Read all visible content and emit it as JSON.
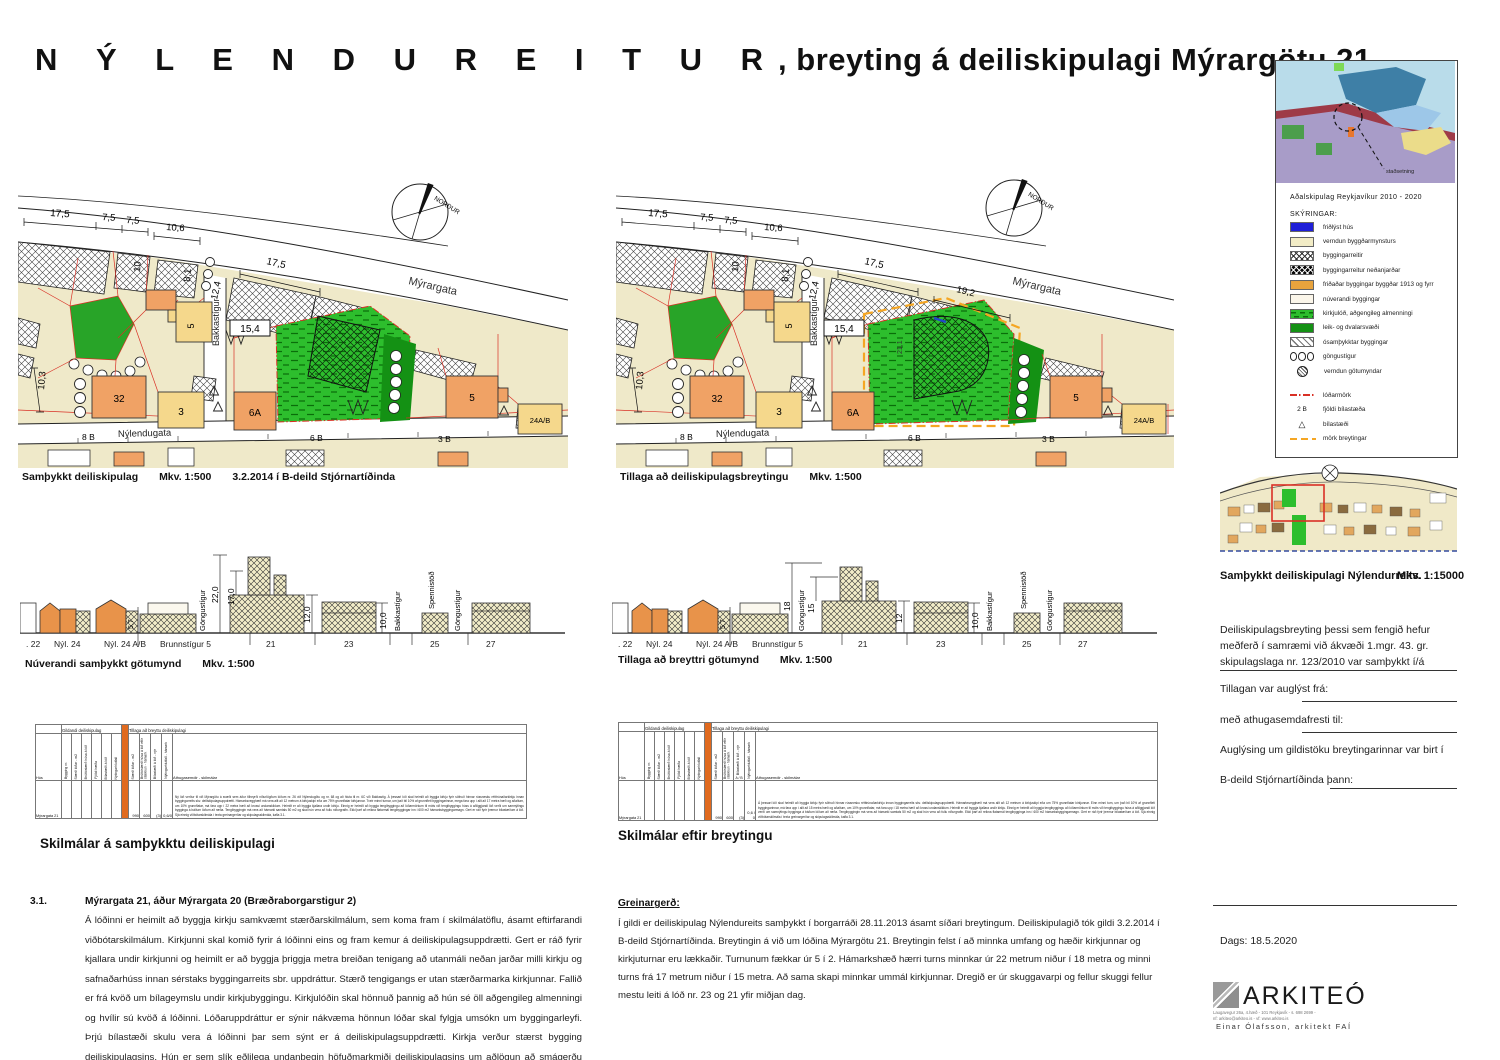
{
  "title": {
    "spaced": "N Ý L E N D U R E I T U R",
    "rest": ", breyting á deiliskipulagi Mýrargötu 21"
  },
  "plan_left": {
    "caption": "Samþykkt deiliskipulag",
    "scale": "Mkv. 1:500",
    "note": "3.2.2014 í B-deild Stjórnartíðinda",
    "north": "NORÐUR",
    "streets": {
      "main": "Mýrargata",
      "cross": "Bakkastígur",
      "bottom": "Nýlendugata"
    },
    "dims": {
      "a": "17,5",
      "b": "7,5",
      "c": "7,5",
      "d": "10,6",
      "e": "10",
      "f": "8,1",
      "g": "12,4",
      "h": "17,5",
      "i": "15,4",
      "j": "10,3"
    },
    "lots": {
      "l1": "8 B",
      "l2": "6 B",
      "l3": "3 B"
    },
    "bld": {
      "b32": "32",
      "b3": "3",
      "b5a": "5",
      "b6a": "6A",
      "b5b": "5",
      "b24": "24A/B"
    }
  },
  "plan_right": {
    "caption": "Tillaga að deiliskipulagsbreytingu",
    "scale": "Mkv. 1:500",
    "north": "NORÐUR",
    "streets": {
      "main": "Mýrargata",
      "cross": "Bakkastígur",
      "bottom": "Nýlendugata"
    },
    "dims": {
      "a": "17,5",
      "b": "7,5",
      "c": "7,5",
      "d": "10,6",
      "e": "10",
      "f": "8,1",
      "g": "12,4",
      "h": "17,5",
      "i": "15,4",
      "j": "10,3",
      "k": "19,2",
      "m": "21,1"
    },
    "lots": {
      "l1": "8 B",
      "l2": "6 B",
      "l3": "3 B"
    },
    "bld": {
      "b32": "32",
      "b3": "3",
      "b5a": "5",
      "b6a": "6A",
      "b5b": "5",
      "b24": "24A/B"
    }
  },
  "elev_left": {
    "caption": "Núverandi samþykkt götumynd",
    "scale": "Mkv. 1:500",
    "heights": {
      "h1": "22,0",
      "h2": "17,0",
      "h3": "12,0",
      "h4": "10,0",
      "h5": "5,7"
    },
    "labels": {
      "v1": "Göngustígur",
      "v2": "Bakkastígur",
      "v3": "Spennistöð",
      "v4": "Göngustígur"
    },
    "lots": {
      "p1": ". 22",
      "p2": "Nýl. 24",
      "p3": "Nýl. 24 A/B",
      "p4": "Brunnstígur 5",
      "p5": "21",
      "p6": "23",
      "p7": "25",
      "p8": "27"
    }
  },
  "elev_right": {
    "caption": "Tillaga að breyttri götumynd",
    "scale": "Mkv. 1:500",
    "heights": {
      "h1": "18",
      "h2": "15",
      "h3": "12",
      "h4": "10,0",
      "h5": "5,7"
    },
    "labels": {
      "v1": "Göngustígur",
      "v2": "Bakkastígur",
      "v3": "Spennistöð",
      "v4": "Göngustígur"
    },
    "lots": {
      "p1": ". 22",
      "p2": "Nýl. 24",
      "p3": "Nýl. 24 A/B",
      "p4": "Brunnstígur 5",
      "p5": "21",
      "p6": "23",
      "p7": "25",
      "p8": "27"
    }
  },
  "table_left": {
    "caption": "Skilmálar á samþykktu deiliskipulagi",
    "group1": "Gildandi deiliskipulag",
    "group2": "Tillaga að breyttu deiliskipulagi",
    "hus": "Hús",
    "note_header": "Athugasemdir - skilmálar",
    "cols": {
      "c1": "Bygging nr.",
      "c2": "Stærð lóðar - m2",
      "c3": "Brúttóstærð húsa á lóð",
      "c4": "Fjöldi hæða",
      "c5": "Bílastæði á lóð",
      "c6": "Nýtingarhlutfall",
      "t1": "Stærð lóðar - m2",
      "t2": "Brúttóstærð húsa á lóð eftir stækkun - hámark",
      "t3": "Bílastæði á lóð - nýr",
      "t4": "Nýtingarhlutfall - hámark"
    },
    "row": {
      "name": "Mýrargata 21",
      "v1": "990",
      "v2": "600",
      "v3": "(3)",
      "v4": "0,6/0",
      "note": "Ný lóð verður til við Mýrargötu á svæði sem áður tilheyrði niðurlögðum lóðum nr. 26 við Nýlendugötu og nr. 68 og að hluta til nr. 6C við Bakkastíg. Á þessari lóð skal heimilt að byggja kirkju fyrir söfnuð hinnar rússnesku rétttrúnaðarkirkju innan byggingarreits skv. deiliskipulagsuppdrætti. Hámarksvegghæð má vera allt að 12 metrum á kirkjuskipi eða um 75% grunnflatar kirkjunnar. Tveir minni turnar, um það bil 10% af grunnfleti byggingarinnar, mega fara upp í allt að 17 metra hæð og aðalturn, um 10% grunnflatar, má fara upp í 22 metra hæð að krossi undanskildum. Heimilt er að byggja kjallara undir kirkju. Einnig er heimilt að byggja tengibyggingu að lóðarmörkum til móts við tengibyggingu húss á aðliggjandi lóð verði um samnýtingu bygginga á báðum lóðum að ræða. Tengibyggingin má vera að hámarki samtals 50 m2 og skal hún vera að fullu niðurgrafin. Ekki þarf að reikna flatarmál tengibyggingar inn í 600 m2 hámarksbyggingarmagn. Gert er ráð fyrir þremur bílastæðum á lóð. Sjá einnig viðbótarskilmála í texta greinargerðar og skipulagsskilmála, kafla 3.1."
    }
  },
  "table_right": {
    "caption": "Skilmálar eftir breytingu",
    "group1": "Gildandi deiliskipulag",
    "group2": "Tillaga að breyttu deiliskipulagi",
    "hus": "Hús",
    "note_header": "Athugasemdir - skilmálar",
    "sub": "A / B",
    "cols": {
      "c1": "Bygging nr.",
      "c2": "Stærð lóðar - m2",
      "c3": "Brúttóstærð húsa á lóð",
      "c4": "Fjöldi hæða",
      "c5": "Bílastæði á lóð",
      "c6": "Nýtingarhlutfall",
      "t1": "Stærð lóðar - m2",
      "t2": "Brúttóstærð húsa á lóð eftir stækkun - hámark",
      "t3": "Bílastæði á lóð - nýr",
      "t4": "Nýtingarhlutfall - hámark"
    },
    "row": {
      "name": "Mýrargata 21",
      "v1": "990",
      "v2": "600",
      "v3": "(3)",
      "v4": "0,6 / 0",
      "note": "Á þessari lóð skal heimilt að byggja kirkju fyrir söfnuð hinnar rússnesku rétttrúnaðarkirkju innan byggingarreits skv. deiliskipulagsuppdrætti. Hámarksvegghæð má vera allt að 12 metrum á kirkjuskipi eða um 75% grunnflatar kirkjunnar. Einn minni turn, um það bil 10% af grunnfleti byggingarinnar, má fara upp í allt að 15 metra hæð og aðalturn, um 10% grunnflatar, má fara upp í 18 metra hæð að krossi undanskildum. Heimilt er að byggja kjallara undir kirkju. Einnig er heimilt að byggja tengibyggingu að lóðarmörkum til móts við tengibyggingu húss á aðliggjandi lóð verði um samnýtingu bygginga á báðum lóðum að ræða. Tengibyggingin má vera að hámarki samtals 50 m2 og skal hún vera að fullu niðurgrafin. Ekki þarf að reikna flatarmál tengibygginga inn í 600 m2 hámarksbyggingarmagn. Gert er ráð fyrir þremur bílastæðum á lóð. Sjá einnig viðbótarskilmála í texta greinargerðar og skipulagsskilmála, kafla 3.1."
    }
  },
  "sec31": {
    "num": "3.1.",
    "heading": "Mýrargata 21, áður Mýrargata 20 (Bræðraborgarstigur 2)",
    "body": "Á lóðinni er heimilt að byggja kirkju samkvæmt stærðarskilmálum, sem koma fram í skilmálatöflu, ásamt eftirfarandi viðbótarskilmálum. Kirkjunni skal komið fyrir á lóðinni eins og fram kemur á deiliskipulagsuppdrætti. Gert er ráð fyrir kjallara undir kirkjunni og heimilt er að byggja þriggja metra breiðan tenigang að utanmáli neðan jarðar milli kirkju og safnaðarhúss innan sérstaks byggingarreits sbr. uppdráttur. Stærð tengigangs er utan stærðarmarka kirkjunnar. Fallið er frá kvöð um bílageymslu undir kirkjubyggingu. Kirkjulóðin skal hönnuð þannig að hún sé öll aðgengileg almenningi og hvílir sú kvöð á lóðinni. Lóðaruppdráttur er sýnir nákvæma hönnun lóðar skal fylgja umsókn um byggingarleyfi. Þrjú bílastæði skulu vera á lóðinni þar sem sýnt er á deiliskipulagsuppdrætti. Kirkja verður stærst bygging deiliskipulagsins. Hún er sem slík eðlilega undanþegin höfuðmarkmiði deiliskipulagsins um aðlögun að smágerðu bygðarmynstri staðarins. Engu að síður eru gerðar strangar kröfur um vandað byggingarlag kirkjunnar og að lögð sé rækt við næsta umhverfi byggingarinnar þannig að hún sómi sér vel sem forystumannvirki á svæðinu."
  },
  "greinargerd": {
    "heading": "Greinargerð:",
    "body": "Í gildi er deiliskipulag Nýlendureits samþykkt í borgarráði 28.11.2013 ásamt síðari breytingum. Deiliskipulagið tók gildi 3.2.2014 í B-deild Stjórnartíðinda. Breytingin á við um lóðina Mýrargötu 21. Breytingin felst í að minnka umfang og hæðir kirkjunnar og kirkjuturnar eru lækkaðir. Turnunum fækkar úr 5 í 2. Hámarkshæð hærri turns minnkar úr 22 metrum niður í 18 metra og minni turns frá 17 metrum niður í 15 metra. Að sama skapi minnkar ummál kirkjunnar. Dregið er úr skuggavarpi og fellur skuggi fellur mestu leiti á lóð nr. 23 og 21 yfir miðjan dag."
  },
  "sidebar": {
    "overview_caption": "Aðalskipulag Reykjavíkur 2010 - 2020",
    "marker": "staðsetning",
    "legend_title": "SKÝRINGAR:",
    "items": [
      {
        "label": "friðlýst hús"
      },
      {
        "label": "verndun byggðarmynsturs"
      },
      {
        "label": "byggingarreitir"
      },
      {
        "label": "byggingarreitur neðanjarðar"
      },
      {
        "label": "friðaðar byggingar byggðar 1913 og fyrr"
      },
      {
        "label": "núverandi byggingar"
      },
      {
        "label": "kirkjulóð, aðgengileg almenningi"
      },
      {
        "label": "leik- og dvalarsvæði"
      },
      {
        "label": "ósamþykktar byggingar"
      },
      {
        "label": "göngustígur"
      },
      {
        "label": "verndun götumyndar"
      },
      {
        "label": "lóðarmörk"
      },
      {
        "label": "fjöldi bílastæða",
        "symbol": "2 B"
      },
      {
        "label": "bílastæði"
      },
      {
        "label": "mörk breytingar"
      }
    ],
    "minimap_caption": "Samþykkt deiliskipulagi Nýlendurreits.",
    "minimap_scale": "Mkv. 1:15000",
    "approval": "Deiliskipulagsbreyting þessi sem fengið hefur meðferð í samræmi við ákvæði 1.mgr. 43. gr. skipulagslaga nr. 123/2010 var samþykkt í/á",
    "f1": "Tillagan var auglýst frá:",
    "f2": "með athugasemdafresti til:",
    "f3": "Auglýsing um gildistöku breytingarinnar var birt í",
    "f4": "B-deild Stjórnartíðinda þann:",
    "date": "Dags: 18.5.2020",
    "firm": {
      "name": "ARKITEÓ",
      "addr1": "Laugavegur 26a, 4.hæð - 101 Reykjavík - s. 698 2699 -",
      "addr2": "nf: arkiteo@arkiteo.is - vf: www.arkiteo.is",
      "person": "Einar Ólafsson, arkitekt FAÍ"
    }
  }
}
